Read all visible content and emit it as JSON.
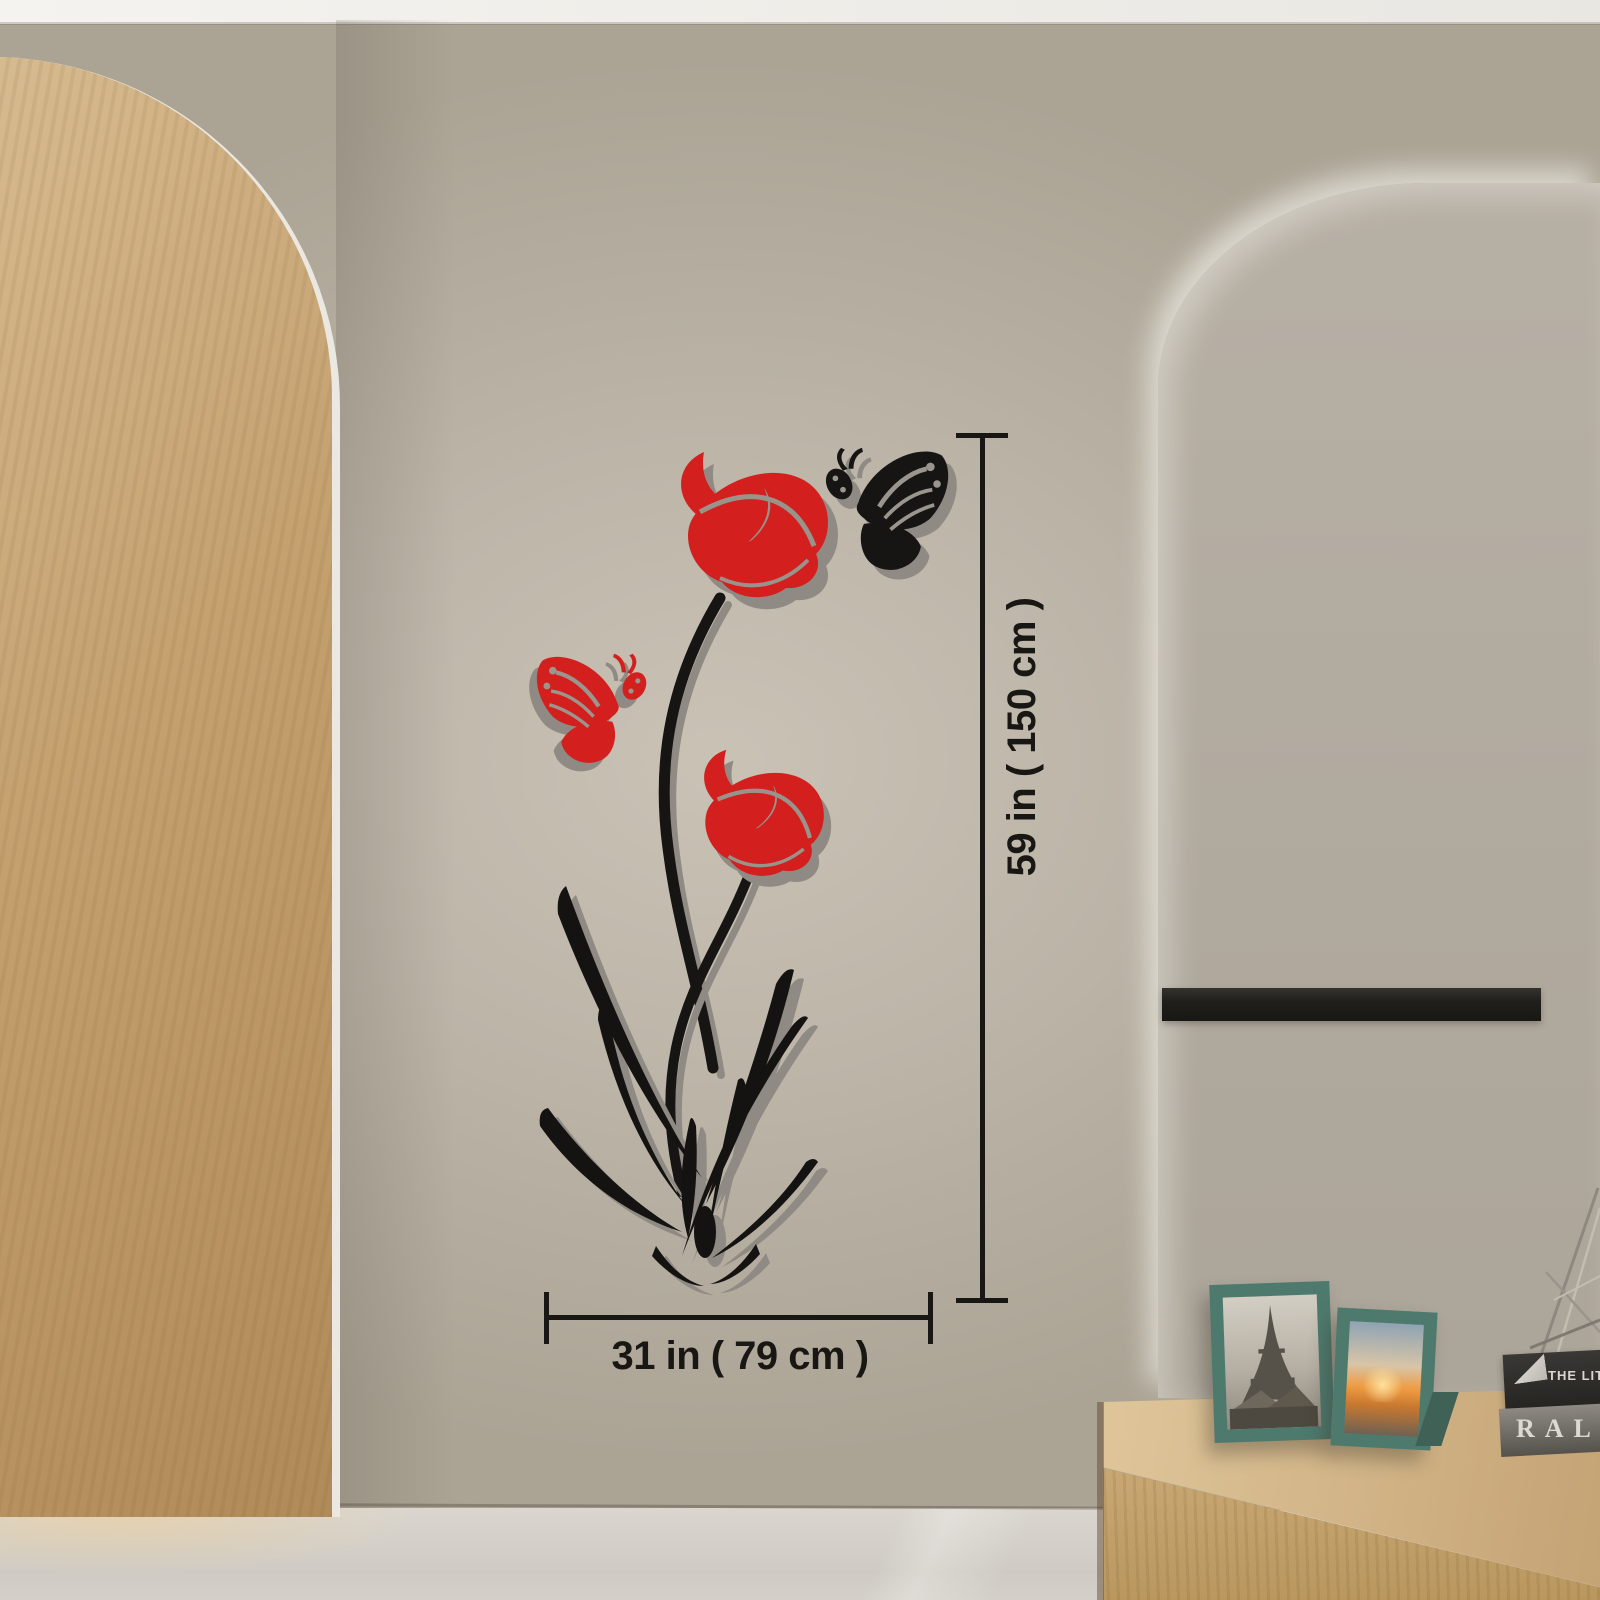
{
  "image": {
    "kind": "product lifestyle photo",
    "subject": "3D red flower and butterfly acrylic wall sticker shown on a hallway wall between an arched bathroom doorway and an arched niche, with printed size annotations"
  },
  "annotations": {
    "height_label": "59 in ( 150 cm )",
    "width_label": "31 in ( 79 cm )"
  },
  "decal": {
    "flower_count": 2,
    "butterfly_count": 2,
    "colors": {
      "red": "#d3201e",
      "black": "#171513",
      "shadow": "#8f8b84"
    }
  },
  "sideboard_items": {
    "book_top_spine": "THE LITTLE B",
    "book_bottom_spine": "RALPH",
    "picture_frames": 2
  },
  "palette": {
    "wall": "#b6afa3",
    "ceiling": "#edebe7",
    "arch_wood": "#c9a97a",
    "tile": "#e7e4de",
    "grout": "#55524c",
    "niche": "#b3aca1",
    "accent_bar": "#23211e",
    "sideboard_wood": "#d3b586",
    "frame_teal": "#4e7a6d",
    "floor": "#d6d2cb",
    "towel": "#d3d2cf",
    "counter": "#ece9e3",
    "cabinet_wood": "#9a7244",
    "glow": "#f6c686"
  }
}
